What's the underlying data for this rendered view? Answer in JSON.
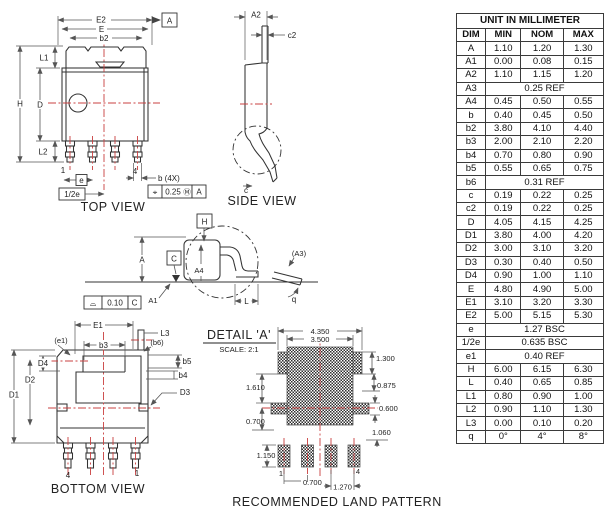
{
  "table": {
    "title": "UNIT IN MILLIMETER",
    "columns": [
      "DIM",
      "MIN",
      "NOM",
      "MAX"
    ],
    "rows": [
      [
        "A",
        "1.10",
        "1.20",
        "1.30"
      ],
      [
        "A1",
        "0.00",
        "0.08",
        "0.15"
      ],
      [
        "A2",
        "1.10",
        "1.15",
        "1.20"
      ],
      [
        "A3",
        "0.25 REF"
      ],
      [
        "A4",
        "0.45",
        "0.50",
        "0.55"
      ],
      [
        "b",
        "0.40",
        "0.45",
        "0.50"
      ],
      [
        "b2",
        "3.80",
        "4.10",
        "4.40"
      ],
      [
        "b3",
        "2.00",
        "2.10",
        "2.20"
      ],
      [
        "b4",
        "0.70",
        "0.80",
        "0.90"
      ],
      [
        "b5",
        "0.55",
        "0.65",
        "0.75"
      ],
      [
        "b6",
        "0.31 REF"
      ],
      [
        "c",
        "0.19",
        "0.22",
        "0.25"
      ],
      [
        "c2",
        "0.19",
        "0.22",
        "0.25"
      ],
      [
        "D",
        "4.05",
        "4.15",
        "4.25"
      ],
      [
        "D1",
        "3.80",
        "4.00",
        "4.20"
      ],
      [
        "D2",
        "3.00",
        "3.10",
        "3.20"
      ],
      [
        "D3",
        "0.30",
        "0.40",
        "0.50"
      ],
      [
        "D4",
        "0.90",
        "1.00",
        "1.10"
      ],
      [
        "E",
        "4.80",
        "4.90",
        "5.00"
      ],
      [
        "E1",
        "3.10",
        "3.20",
        "3.30"
      ],
      [
        "E2",
        "5.00",
        "5.15",
        "5.30"
      ],
      [
        "e",
        "1.27 BSC"
      ],
      [
        "1/2e",
        "0.635 BSC"
      ],
      [
        "e1",
        "0.40 REF"
      ],
      [
        "H",
        "6.00",
        "6.15",
        "6.30"
      ],
      [
        "L",
        "0.40",
        "0.65",
        "0.85"
      ],
      [
        "L1",
        "0.80",
        "0.90",
        "1.00"
      ],
      [
        "L2",
        "0.90",
        "1.10",
        "1.30"
      ],
      [
        "L3",
        "0.00",
        "0.10",
        "0.20"
      ],
      [
        "q",
        "0°",
        "4°",
        "8°"
      ]
    ]
  },
  "top_view": {
    "title": "TOP VIEW",
    "labels": {
      "e2": "E2",
      "e": "E",
      "b2": "b2",
      "datum_a": "A",
      "h": "H",
      "d": "D",
      "l1": "L1",
      "l2": "L2",
      "pin1": "1",
      "pin4": "4",
      "e_pitch": "e",
      "half_e": "1/2e",
      "b_4x": "b (4X)",
      "pos_sym": "⌖",
      "pos_tol": "0.25",
      "pos_mod": "Ⓜ",
      "pos_datum": "A"
    }
  },
  "side_view": {
    "title": "SIDE VIEW",
    "labels": {
      "a2": "A2",
      "c2": "c2",
      "c": "c"
    }
  },
  "detail_view": {
    "labels": {
      "h": "H",
      "a": "A",
      "datum_c": "C",
      "a4": "A4",
      "a1": "A1",
      "a3": "(A3)",
      "l": "L",
      "q": "q",
      "flat_sym": "⌓",
      "flat_tol": "0.10",
      "flat_datum": "C"
    }
  },
  "bottom_view": {
    "title": "BOTTOM VIEW",
    "labels": {
      "e1": "E1",
      "e1_ref": "(e1)",
      "b3": "b3",
      "l3": "L3",
      "b6_ref": "(b6)",
      "b5": "b5",
      "b4": "b4",
      "d4": "D4",
      "d2": "D2",
      "d1": "D1",
      "d3": "D3",
      "pin4": "4",
      "pin1": "1"
    }
  },
  "detail_a": {
    "title": "DETAIL 'A'",
    "scale": "SCALE: 2:1"
  },
  "land_pattern": {
    "title": "RECOMMENDED LAND PATTERN",
    "labels": {
      "w_outer": "4.350",
      "w_inner": "3.500",
      "ear_h": "1.300",
      "r1": "0.875",
      "r2": "0.600",
      "r3": "1.060",
      "left1": "1.610",
      "left2": "0.700",
      "pad_h": "1.150",
      "pitch_a": "0.700",
      "pitch_b": "1.270",
      "pin1": "1",
      "pin4": "4"
    }
  },
  "colors": {
    "object_line": "#333333",
    "dimension_line": "#555555",
    "centerline_red": "#c94040",
    "hatch": "#2e2e2e",
    "background": "#ffffff"
  }
}
